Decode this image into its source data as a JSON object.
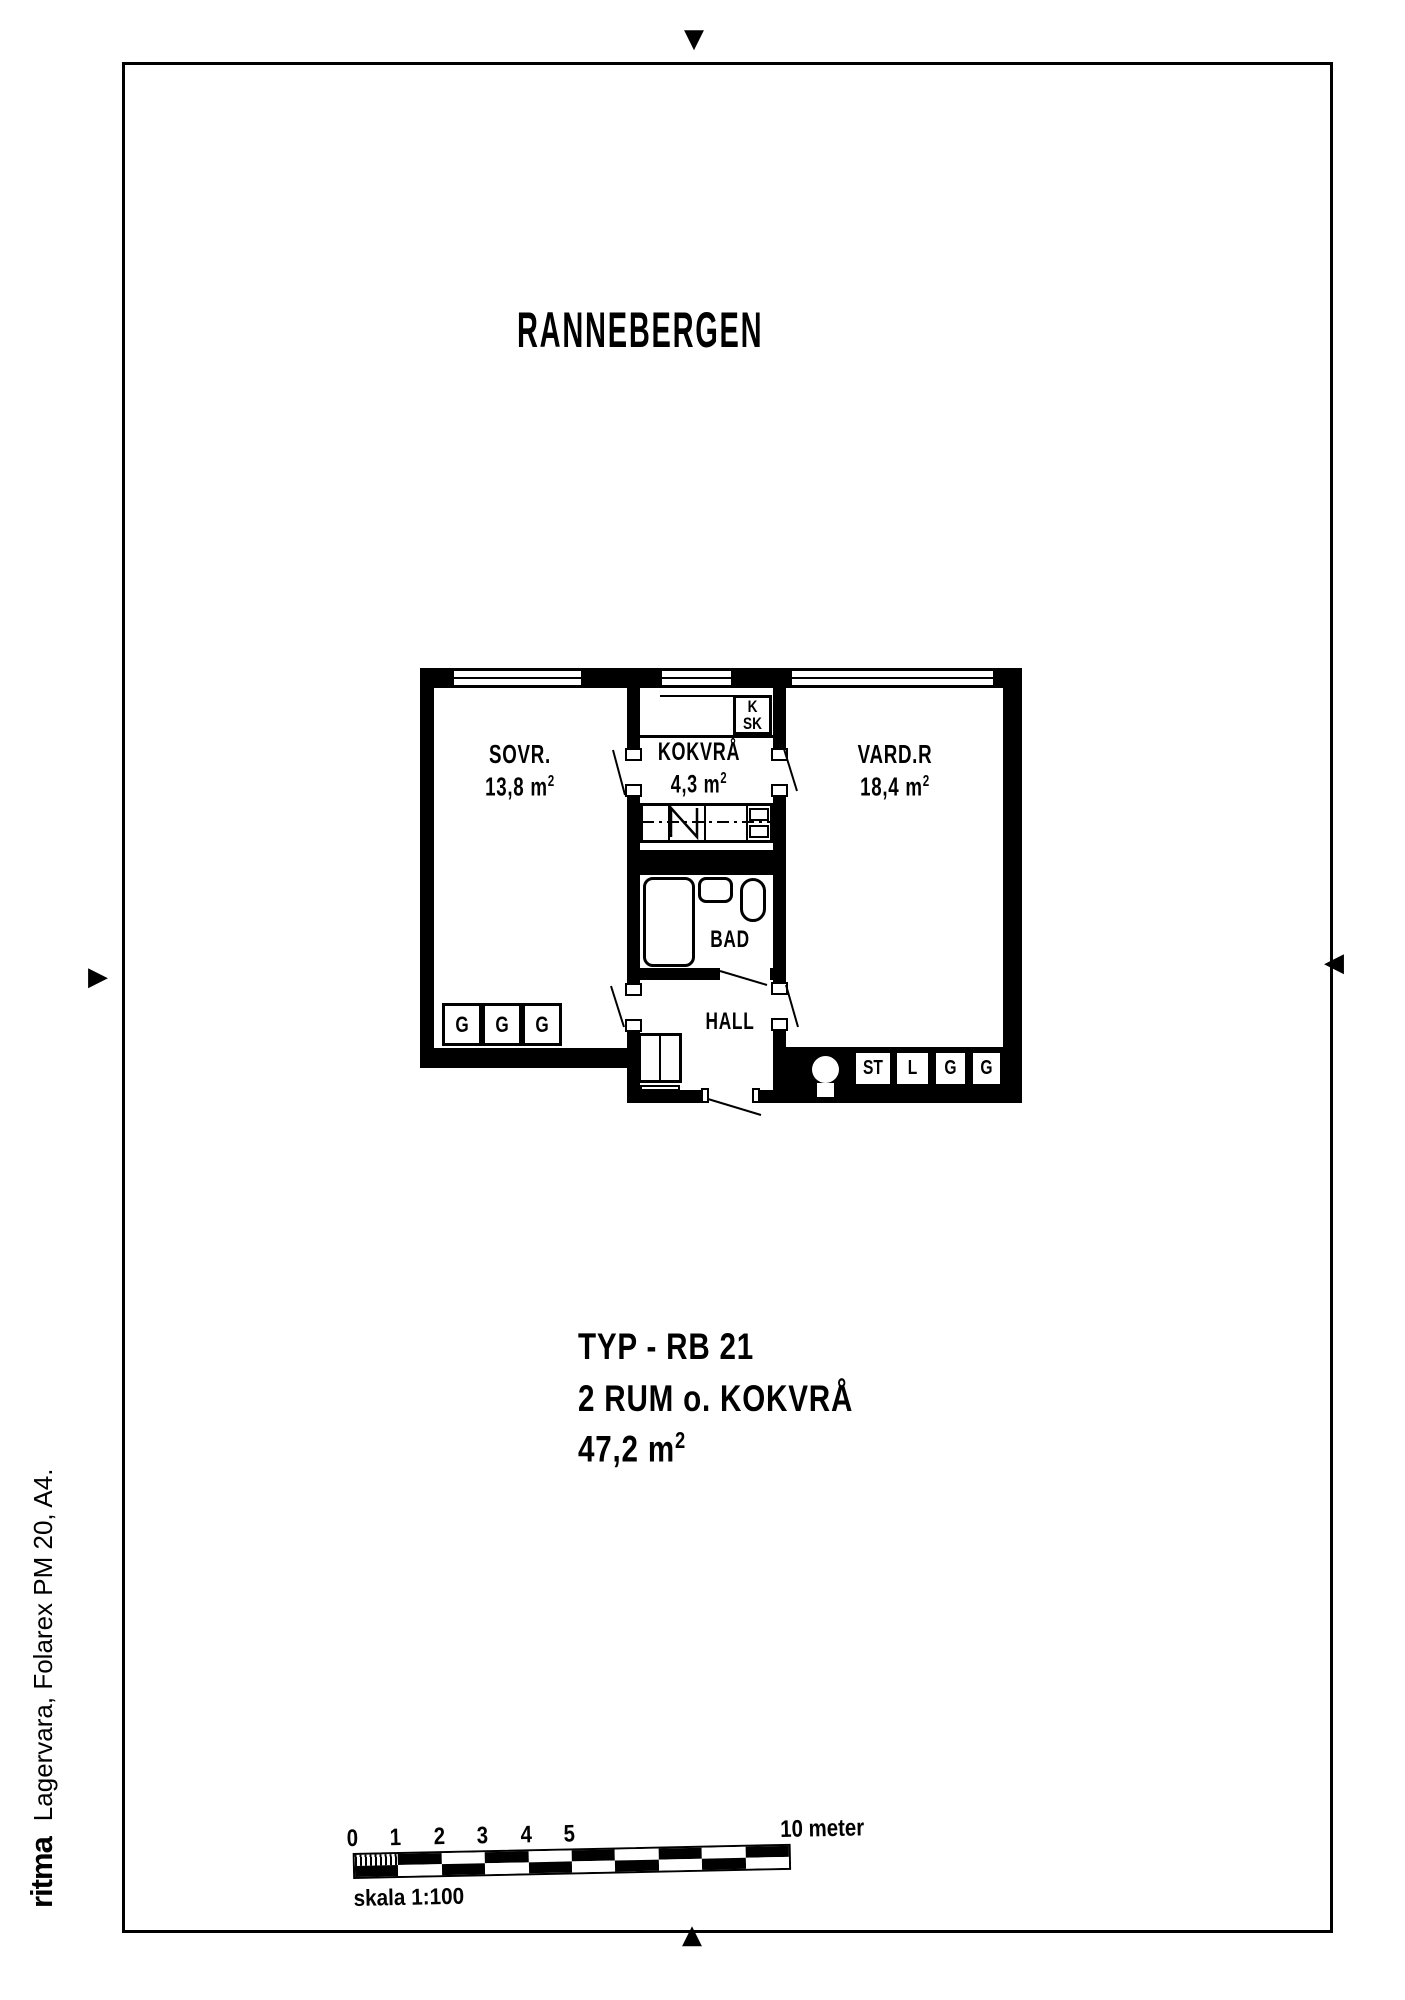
{
  "title": "RANNEBERGEN",
  "plan": {
    "rooms": {
      "sovr": {
        "label": "SOVR.",
        "area": "13,8 m",
        "sup": "2"
      },
      "kokvra": {
        "label": "KOKVRÅ",
        "area": "4,3 m",
        "sup": "2"
      },
      "vardr": {
        "label": "VARD.R",
        "area": "18,4 m",
        "sup": "2"
      },
      "bad": {
        "label": "BAD"
      },
      "hall": {
        "label": "HALL"
      }
    },
    "closets": {
      "k": "K",
      "sk": "SK",
      "sovr_row": [
        "G",
        "G",
        "G"
      ],
      "vardr_row": [
        "ST",
        "L",
        "G",
        "G"
      ]
    }
  },
  "type_block": {
    "type_label": "TYP - RB 21",
    "rooms_label": "2 RUM o. KOKVRÅ",
    "area": "47,2 m",
    "sup": "2"
  },
  "scale_bar": {
    "ticks": [
      "0",
      "1",
      "2",
      "3",
      "4",
      "5"
    ],
    "end_label": "10 meter",
    "caption": "skala 1:100"
  },
  "margin_note": {
    "logo": "ritma",
    "text": "Lagervara, Folarex PM 20, A4."
  },
  "marks": {
    "top": "▼",
    "bottom": "▲",
    "left": "▶",
    "right": "◀"
  },
  "colors": {
    "ink": "#000000",
    "paper": "#ffffff"
  }
}
